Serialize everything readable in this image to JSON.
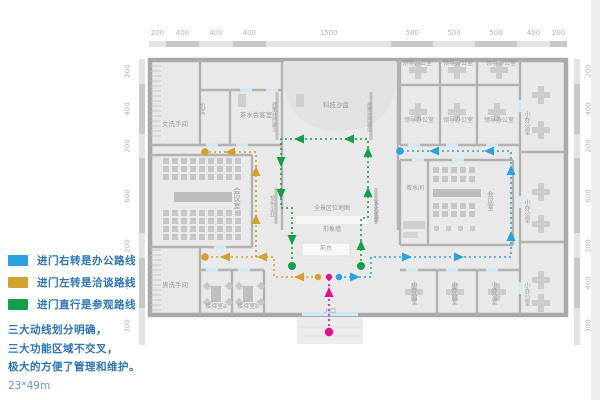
{
  "legend": {
    "routes": [
      {
        "key": "office",
        "label": "进门右转是办公路线"
      },
      {
        "key": "talk",
        "label": "进门左转是洽谈路线"
      },
      {
        "key": "visit",
        "label": "进门直行是参观路线"
      }
    ],
    "notes": [
      "三大动线划分明确，",
      "三大功能区域不交叉，",
      "极大的方便了管理和维护。"
    ],
    "size": "23*49m"
  },
  "colors": {
    "office": "#29A3E0",
    "talk": "#D1A32E",
    "visit": "#149E4C",
    "entry": "#E60E8E"
  },
  "rulers": {
    "top": [
      "200",
      "400",
      "400",
      "400",
      "1500",
      "500",
      "500",
      "500",
      "400",
      "200"
    ],
    "left": [
      "200",
      "400",
      "200",
      "600",
      "200",
      "400",
      "300"
    ],
    "right": [
      "200",
      "400",
      "200",
      "600",
      "200",
      "400",
      "300"
    ]
  },
  "rooms": {
    "women_wc": "女洗手间",
    "machine_room": "机房",
    "tea_reception": "茶水会客室",
    "tech_sandbox": "科技沙盘",
    "policy_wall": "政策扶持展示",
    "leading_wall": "龙头企业",
    "advantage_wall": "五大优势",
    "map_wall": "全景区位地图",
    "image_wall": "形象墙",
    "front_desk": "前台",
    "meeting_room": "会议室",
    "men_wc": "男洗手间",
    "reception_a": "接待室a",
    "reception_b": "接待室b",
    "leader_office": "领导办公室",
    "small_office": "小办公室",
    "tea_room": "茶水间",
    "meeting_room2": "会议室",
    "entrance": "入口"
  }
}
